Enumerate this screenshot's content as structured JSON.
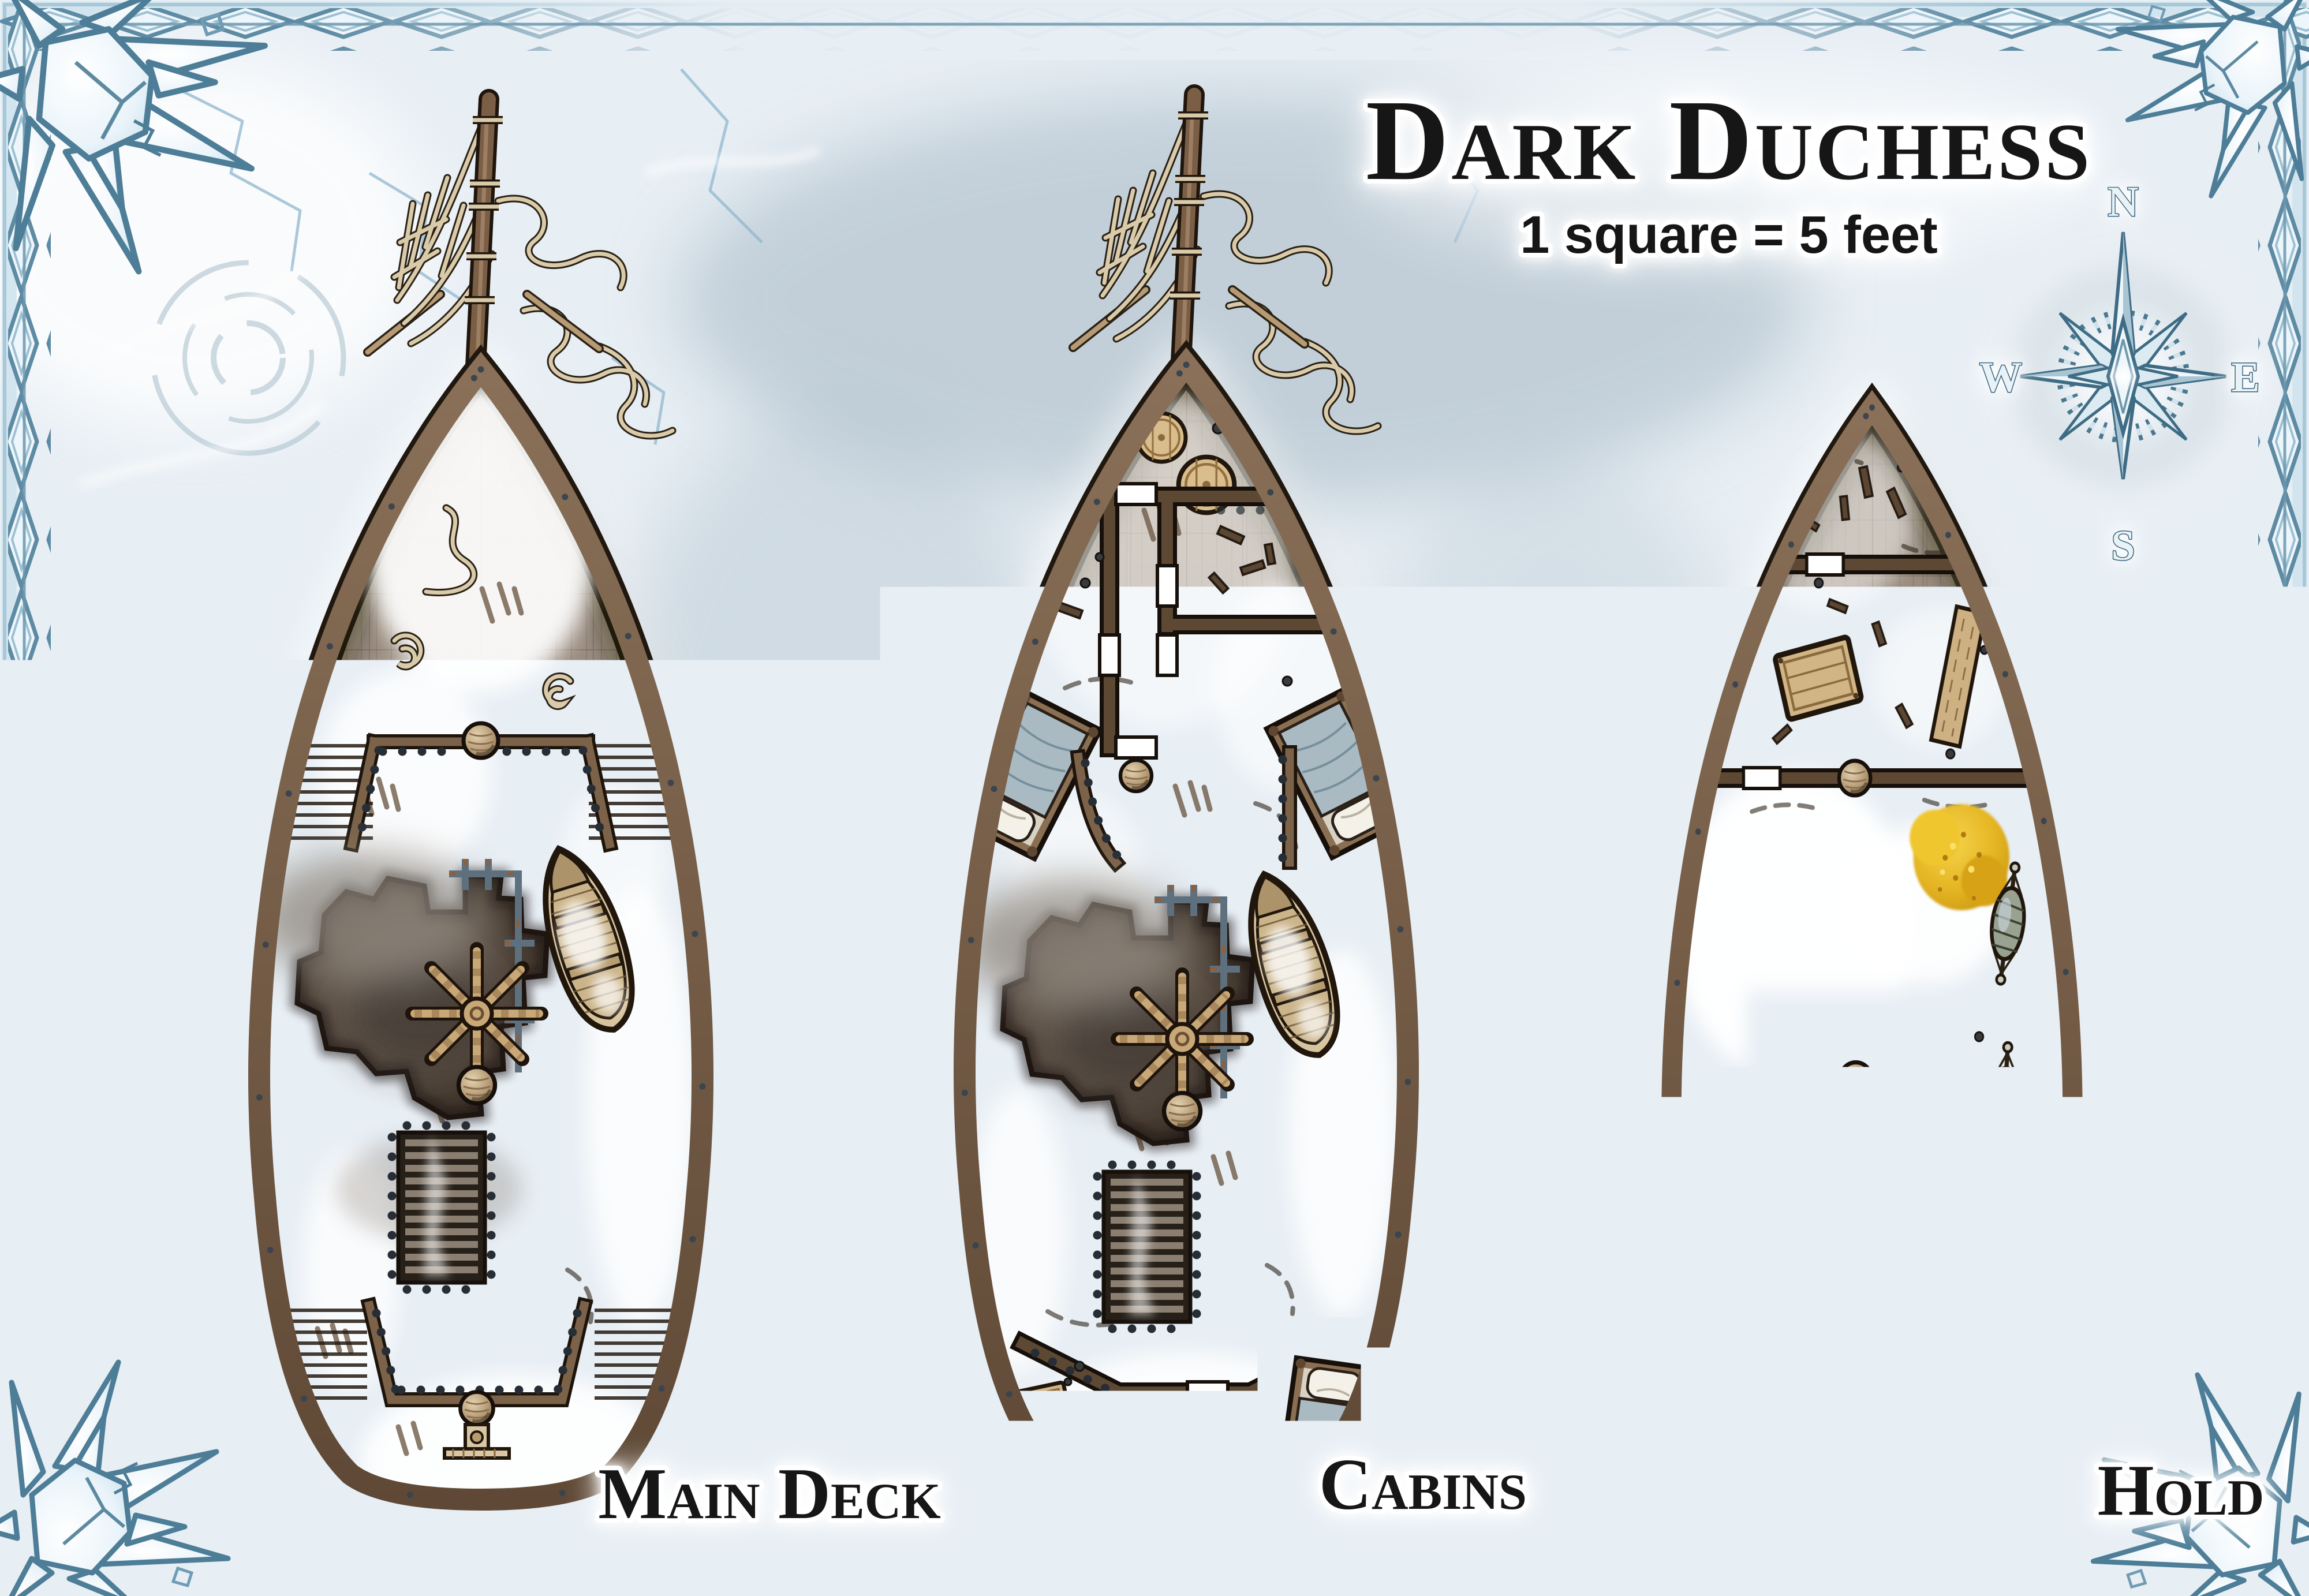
{
  "map": {
    "title": "Dark Duchess",
    "scale_note": "1 square = 5 feet",
    "decks": [
      {
        "id": "main-deck",
        "label": "Main Deck"
      },
      {
        "id": "cabins",
        "label": "Cabins"
      },
      {
        "id": "hold",
        "label": "Hold"
      }
    ],
    "compass": {
      "north": "N",
      "east": "E",
      "south": "S",
      "west": "W"
    },
    "grid_size_px": 97,
    "colors": {
      "background_ice": "#e7eef4",
      "border_ice": "#edf6fb",
      "border_outline": "#5d8ba3",
      "hull_wood": "#7e6751",
      "deck_wood": "#98897b",
      "hole_dark": "#261f18",
      "snow": "#ffffff",
      "gold_pile": "#e3b322",
      "label_text": "#121212"
    }
  }
}
